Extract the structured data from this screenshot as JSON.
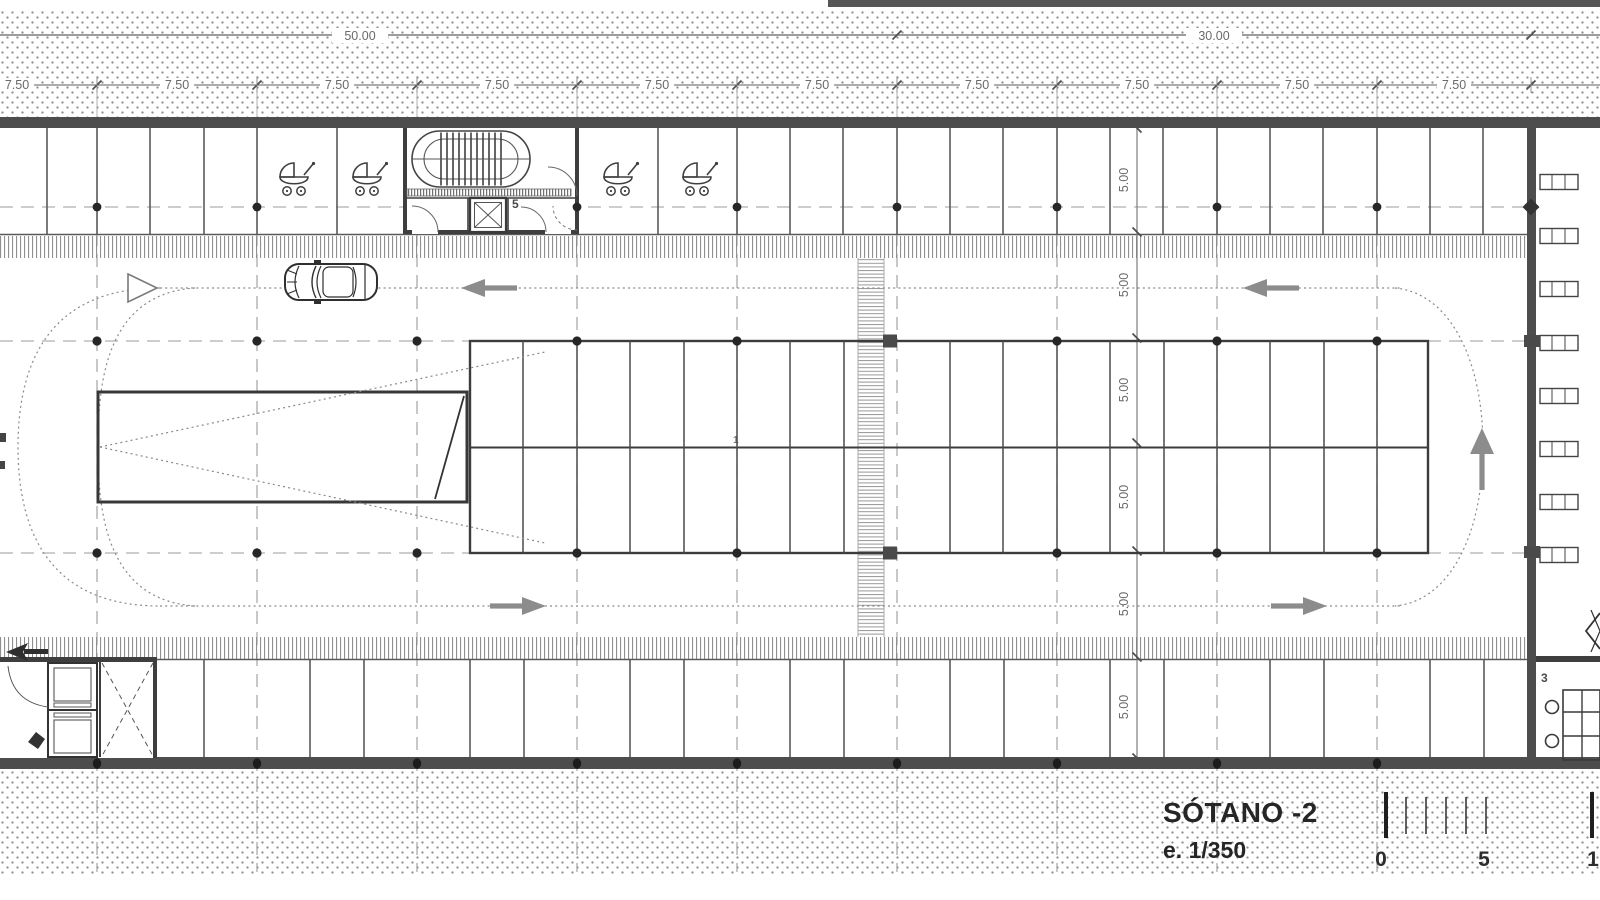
{
  "titleblock": {
    "title": "SÓTANO -2",
    "scale": "e. 1/350",
    "bar_labels": [
      "0",
      "5",
      "1"
    ]
  },
  "dimensions": {
    "total_left": "50.00",
    "total_right": "30.00",
    "segment": "7.50",
    "segment_count": 10,
    "vertical": "5.00",
    "vertical_count": 6
  },
  "rooms": {
    "stair_core": "5",
    "office": "3",
    "grid_note": "1"
  },
  "icons": [
    "stroller-icon",
    "car-icon",
    "flow-arrow-left-icon",
    "flow-arrow-right-icon",
    "flow-arrow-up-icon",
    "ramp-direction-arrow-icon",
    "entry-arrow-icon",
    "stair-icon",
    "elevator-shaft-icon",
    "column-dot-icon",
    "bowtie-mark-icon"
  ],
  "colors": {
    "wall": "#4d4d4d",
    "line": "#555555",
    "grid": "#9b9b9b",
    "hatch": "#909090",
    "arrow": "#8c8c8c",
    "dim_text": "#6a6a6a",
    "title_text": "#262626",
    "earth_dot": "#8e8e8e"
  }
}
